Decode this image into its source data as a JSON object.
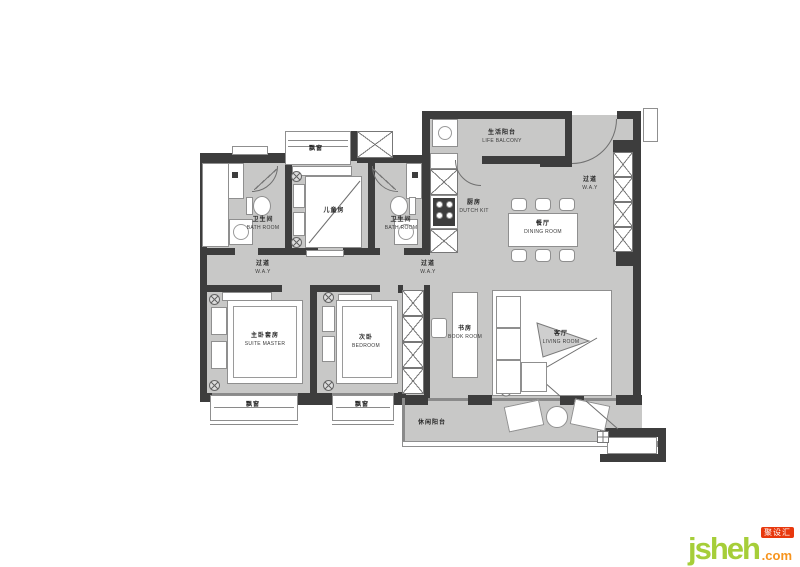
{
  "colors": {
    "wall": "#3d3d3d",
    "floor": "#c8c8c7",
    "furniture_line": "#8f8f8f",
    "label_text": "#262626",
    "logo_green": "#a6ce39",
    "logo_orange": "#f7941d",
    "logo_red": "#e8380d"
  },
  "icons": {
    "plant": "circle-cross-plant",
    "wardrobe": "x-lattice-cabinet",
    "stove": "four-burner-cooktop",
    "washer": "drum-washer",
    "door": "quarter-arc-swing"
  },
  "labels": {
    "bath_master": {
      "zh": "卫生间",
      "en": "BATH ROOM"
    },
    "bath_second": {
      "zh": "卫生间",
      "en": "BATH ROOM"
    },
    "kids_room": {
      "zh": "儿童房",
      "en": ""
    },
    "kids_bay_window": {
      "zh": "飘窗",
      "en": ""
    },
    "kitchen": {
      "zh": "厨房",
      "en": "DUTCH KIT"
    },
    "life_balcony": {
      "zh": "生活阳台",
      "en": "LIFE BALCONY"
    },
    "entry_hall": {
      "zh": "过道",
      "en": "W.A.Y"
    },
    "dining_room": {
      "zh": "餐厅",
      "en": "DINING ROOM"
    },
    "hall_left": {
      "zh": "过道",
      "en": "W.A.Y"
    },
    "hall_mid": {
      "zh": "过道",
      "en": "W.A.Y"
    },
    "master_bedroom": {
      "zh": "主卧套房",
      "en": "SUITE MASTER"
    },
    "second_bedroom": {
      "zh": "次卧",
      "en": "BEDROOM"
    },
    "study": {
      "zh": "书房",
      "en": "BOOK ROOM"
    },
    "living_room": {
      "zh": "客厅",
      "en": "LIVING ROOM"
    },
    "leisure_balcony": {
      "zh": "休闲阳台",
      "en": ""
    },
    "bay_window_left": {
      "zh": "飘窗",
      "en": ""
    },
    "bay_window_right": {
      "zh": "飘窗",
      "en": ""
    }
  },
  "logo": {
    "brand": "jsheh",
    "tld": ".com",
    "badge": "聚设汇"
  }
}
